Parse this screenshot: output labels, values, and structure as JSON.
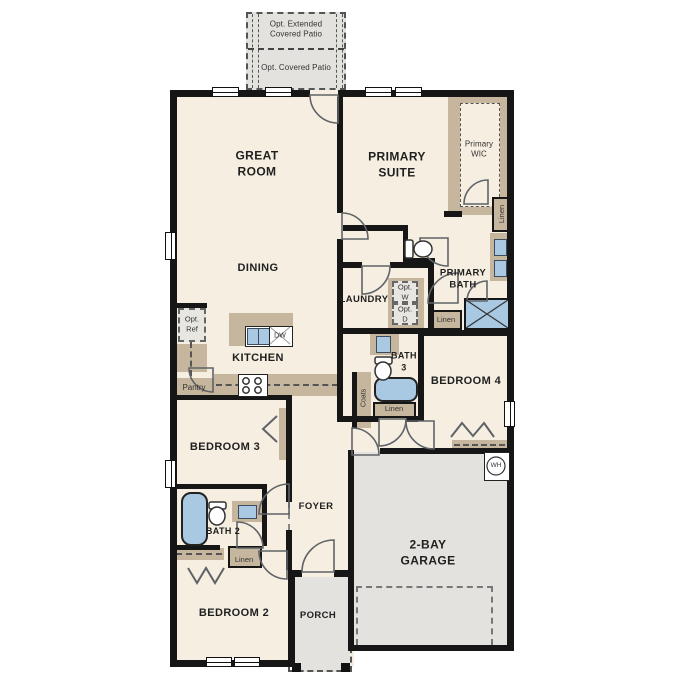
{
  "colors": {
    "floor": "#f6efe1",
    "exterior_concrete": "#e3e2de",
    "cabinet_tan": "#c6b69d",
    "fixture_blue": "#a9c8e2",
    "wall_black": "#161616"
  },
  "patio": {
    "extended_label": "Opt. Extended\nCovered Patio",
    "covered_label": "Opt. Covered Patio"
  },
  "rooms": {
    "great_room": "GREAT\nROOM",
    "dining": "DINING",
    "primary_suite": "PRIMARY\nSUITE",
    "primary_wic": "Primary\nWIC",
    "primary_bath": "PRIMARY\nBATH",
    "laundry": "LAUNDRY",
    "kitchen": "KITCHEN",
    "bath3": "BATH\n3",
    "bedroom4": "BEDROOM 4",
    "bedroom3": "BEDROOM 3",
    "foyer": "FOYER",
    "bath2": "BATH 2",
    "bedroom2": "BEDROOM 2",
    "porch": "PORCH",
    "garage": "2-BAY\nGARAGE"
  },
  "closets": {
    "linen_wic": "Linen",
    "linen_primary_bath": "Linen",
    "linen_hall": "Linen",
    "linen_bath2": "Linen",
    "coats": "Coats",
    "pantry": "Pantry"
  },
  "appliances": {
    "opt_ref": "Opt.\nRef",
    "opt_washer": "Opt.\nW",
    "opt_dryer": "Opt.\nD",
    "dishwasher": "DW",
    "water_heater": "WH"
  }
}
